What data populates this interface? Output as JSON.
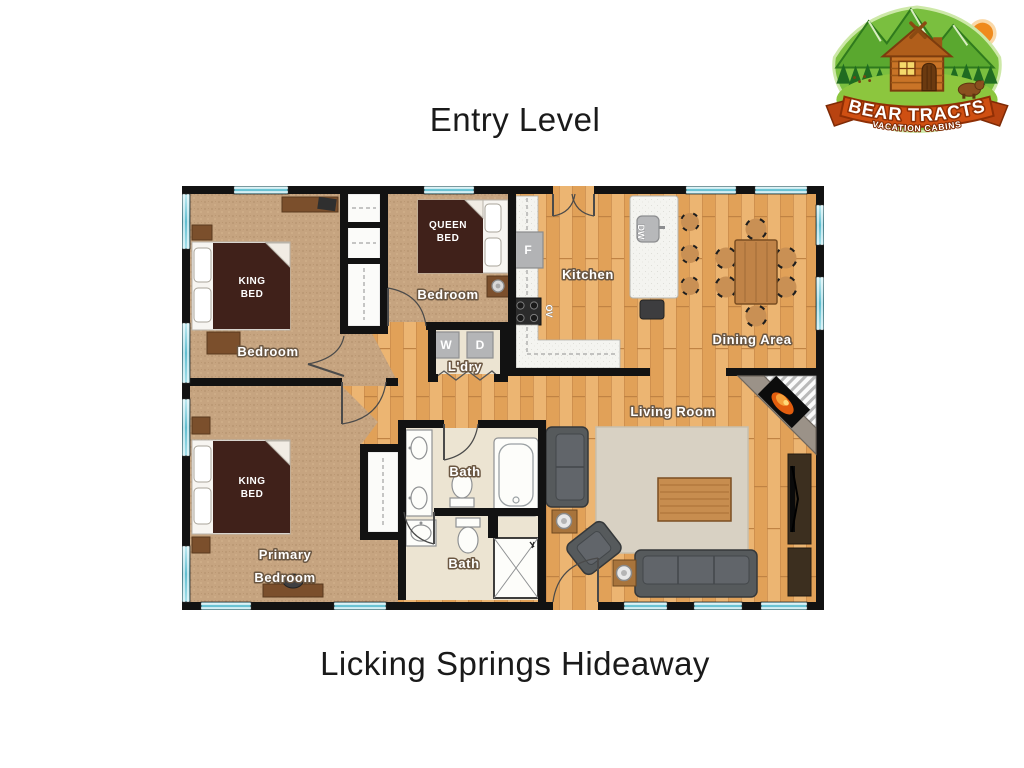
{
  "header": {
    "title": "Entry Level"
  },
  "footer": {
    "title": "Licking Springs Hideaway"
  },
  "logo": {
    "line1": "BEAR TRACTS",
    "line2": "VACATION CABINS"
  },
  "plan": {
    "rooms": {
      "bedroom1": "Bedroom",
      "bedroom2": "Bedroom",
      "kitchen": "Kitchen",
      "dining": "Dining Area",
      "living": "Living Room",
      "primary_l1": "Primary",
      "primary_l2": "Bedroom",
      "bath1": "Bath",
      "bath2": "Bath",
      "laundry": "L'dry"
    },
    "beds": {
      "king1": {
        "l1": "KING",
        "l2": "BED"
      },
      "queen": {
        "l1": "QUEEN",
        "l2": "BED"
      },
      "king2": {
        "l1": "KING",
        "l2": "BED"
      }
    },
    "appliances": {
      "fridge": "F",
      "washer": "W",
      "dryer": "D",
      "oven": "OV",
      "dishwasher": "DW"
    },
    "colors": {
      "wall": "#121212",
      "window_teal": "#7bcfdd",
      "wood_floor": "#e6aa64",
      "carpet": "#c6a480",
      "bath_floor": "#ece4d2",
      "bed_blanket": "#40211a",
      "sofa_gray": "#565a5c",
      "logo_green": "#7abf3f",
      "banner_orange": "#cf4f12"
    }
  }
}
